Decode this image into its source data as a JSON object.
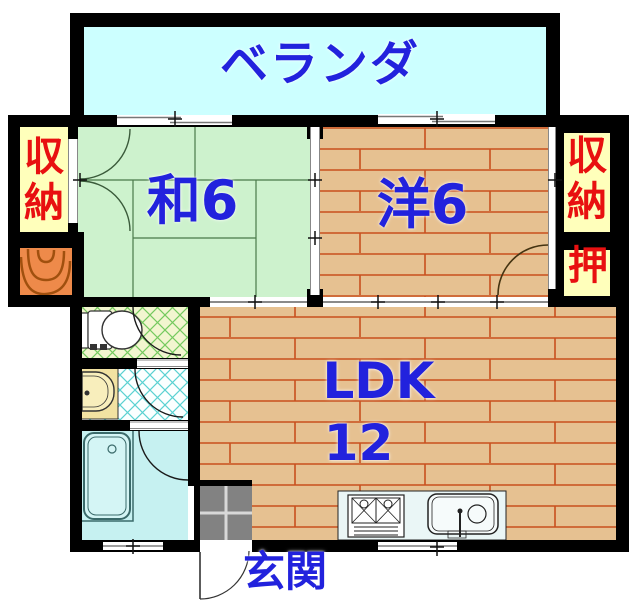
{
  "plan": {
    "labels": {
      "veranda": "ベランダ",
      "japanese_room": "和6",
      "western_room": "洋6",
      "ldk_line1": "LDK",
      "ldk_line2": "12",
      "entrance": "玄関",
      "storage_left": "収納",
      "storage_right": "収納",
      "closet": "押"
    },
    "colors": {
      "room_label_blue": "#2222dd",
      "storage_label_red": "#e81010",
      "veranda_floor": "#ccffff",
      "tatami_floor": "#cdf2cd",
      "tatami_line": "#4a7a4a",
      "wood_floor": "#e6c191",
      "wood_plank_line": "#c8501e",
      "storage_floor": "#ffffbb",
      "porch_box_orange": "#ee8a4a",
      "toilet_floor": "#f2f5cf",
      "washroom_floor": "#fbffff",
      "bathroom_floor": "#c6f1f1",
      "entrance_tile_gray": "#828282",
      "wall": "#000000"
    },
    "fixtures": [
      "toilet",
      "washbasin",
      "bathtub",
      "kitchen-counter",
      "gas-stove",
      "kitchen-sink",
      "entrance-tile",
      "door-swings",
      "sliding-windows"
    ]
  }
}
